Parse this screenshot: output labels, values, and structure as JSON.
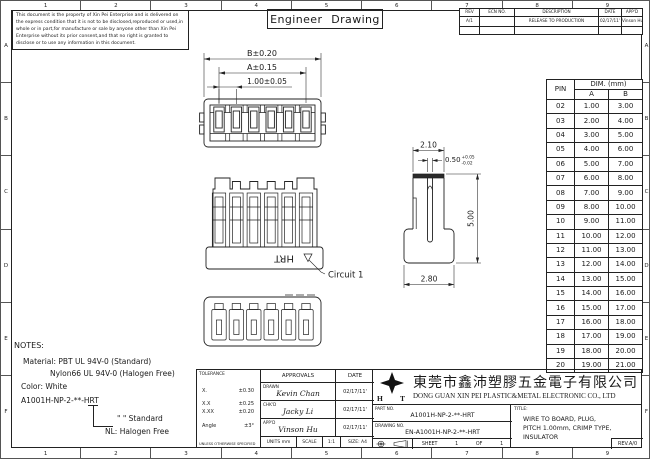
{
  "sheet": {
    "grid_top": [
      "1",
      "2",
      "3",
      "4",
      "5",
      "6",
      "7",
      "8",
      "9"
    ],
    "grid_bottom": [
      "1",
      "2",
      "3",
      "4",
      "5",
      "6",
      "7",
      "8",
      "9"
    ],
    "grid_left": [
      "A",
      "B",
      "C",
      "D",
      "E",
      "F"
    ],
    "grid_right": [
      "A",
      "B",
      "C",
      "D",
      "E",
      "F"
    ],
    "title": "Engineer Drawing",
    "disclaimer": "This document is the property of Xin Pei Enterprise and is delivered on the express condition that it is not to be disclosed,reproduced or used,in whole or in part,for manufacture or sale by anyone other than Xin Pei Enterprise without its prior consent,and that no right is granted to disclose or to use any information in this document."
  },
  "revision_table": {
    "headers": [
      "REV",
      "ECN NO.",
      "DESCRIPTION",
      "DATE",
      "APP'D"
    ],
    "rows": [
      [
        "A/1",
        "",
        "RELEASE TO PRODUCTION",
        "02/17/11'",
        "Vinson Hu"
      ]
    ]
  },
  "pin_table": {
    "pin_header": "PIN",
    "dim_header": "DIM. (mm)",
    "col_a": "A",
    "col_b": "B",
    "rows": [
      [
        "02",
        "1.00",
        "3.00"
      ],
      [
        "03",
        "2.00",
        "4.00"
      ],
      [
        "04",
        "3.00",
        "5.00"
      ],
      [
        "05",
        "4.00",
        "6.00"
      ],
      [
        "06",
        "5.00",
        "7.00"
      ],
      [
        "07",
        "6.00",
        "8.00"
      ],
      [
        "08",
        "7.00",
        "9.00"
      ],
      [
        "09",
        "8.00",
        "10.00"
      ],
      [
        "10",
        "9.00",
        "11.00"
      ],
      [
        "11",
        "10.00",
        "12.00"
      ],
      [
        "12",
        "11.00",
        "13.00"
      ],
      [
        "13",
        "12.00",
        "14.00"
      ],
      [
        "14",
        "13.00",
        "15.00"
      ],
      [
        "15",
        "14.00",
        "16.00"
      ],
      [
        "16",
        "15.00",
        "17.00"
      ],
      [
        "17",
        "16.00",
        "18.00"
      ],
      [
        "18",
        "17.00",
        "19.00"
      ],
      [
        "19",
        "18.00",
        "20.00"
      ],
      [
        "20",
        "19.00",
        "21.00"
      ]
    ]
  },
  "drawing": {
    "dims": {
      "front_overall": "B±0.20",
      "front_inner": "A±0.15",
      "front_pitch": "1.00±0.05",
      "side_top_width": "2.10",
      "side_slot": "0.50",
      "side_slot_tol_plus": "+0.05",
      "side_slot_tol_minus": "-0.02",
      "side_height": "5.00",
      "side_bottom_width": "2.80"
    },
    "labels": {
      "marking": "HRT",
      "circuit": "Circuit 1"
    }
  },
  "notes": {
    "heading": "NOTES:",
    "material": "Material: PBT UL 94V-0 (Standard)",
    "material2": "Nylon66 UL 94V-0 (Halogen Free)",
    "color": "Color: White",
    "part_code": "A1001H-NP-2-**-HRT",
    "option_standard": "\"  \" Standard",
    "option_halogen": "NL: Halogen Free"
  },
  "title_block": {
    "tolerance": {
      "heading": "TOLERANCE",
      "rows": [
        [
          "X.",
          "±0.30"
        ],
        [
          "X.X",
          "±0.25"
        ],
        [
          "X.XX",
          "±0.20"
        ],
        [
          "Angle",
          "±3°"
        ]
      ],
      "footer": "UNLESS OTHERWISE SPECIFIED"
    },
    "approvals": {
      "heading": "APPROVALS",
      "date_heading": "DATE",
      "rows": [
        {
          "role": "DRAWN",
          "name": "Kevin Chan",
          "date": "02/17/11'"
        },
        {
          "role": "CHK'D",
          "name": "Jacky Li",
          "date": "02/17/11'"
        },
        {
          "role": "APP'D",
          "name": "Vinson Hu",
          "date": "02/17/11'"
        }
      ],
      "units": "UNITS mm",
      "scale_label": "SCALE",
      "scale_value": "1:1",
      "size": "SIZE: A4"
    },
    "company": {
      "logo_left": "H",
      "logo_right": "T",
      "name_cn": "東莞市鑫沛塑膠五金電子有限公司",
      "name_en": "DONG GUAN XIN PEI PLASTIC&METAL ELECTRONIC CO., LTD"
    },
    "part_no_label": "PART NO.",
    "part_no": "A1001H-NP-2-**-HRT",
    "drawing_no_label": "DRAWING NO.",
    "drawing_no": "EN-A1001H-NP-2-**-HRT",
    "sheet_label": "SHEET",
    "sheet_num": "1",
    "of_label": "OF",
    "of_num": "1",
    "title_label": "TITLE:",
    "title_line1": "WIRE TO BOARD, PLUG,",
    "title_line2": "PITCH 1.00mm, CRIMP TYPE,",
    "title_line3": "INSULATOR",
    "rev": "REV.A/0"
  }
}
